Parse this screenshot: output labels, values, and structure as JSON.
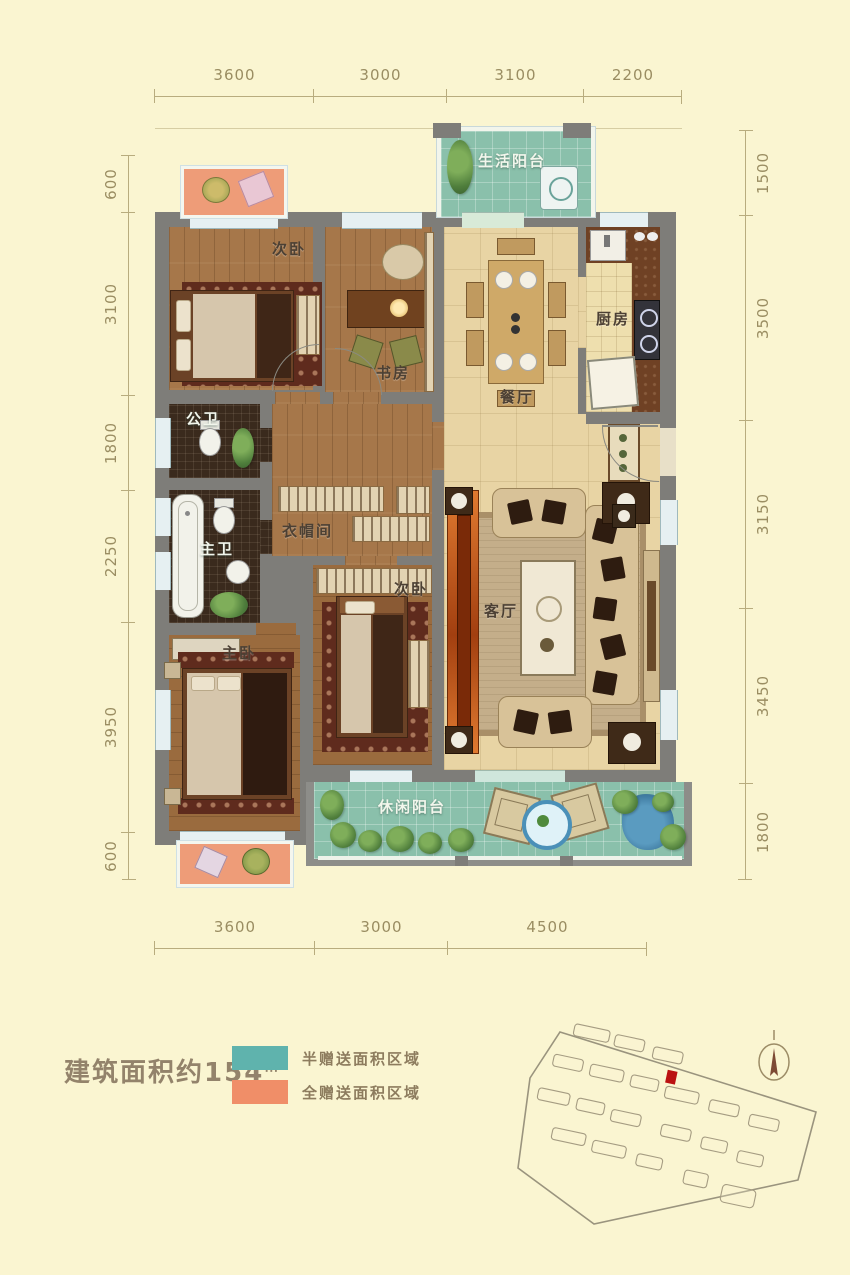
{
  "dimensions": {
    "top": [
      "3600",
      "3000",
      "3100",
      "2200"
    ],
    "bottom": [
      "3600",
      "3000",
      "4500"
    ],
    "left": [
      "600",
      "3100",
      "1800",
      "2250",
      "3950",
      "600"
    ],
    "right": [
      "1500",
      "3500",
      "3150",
      "3450",
      "1800"
    ]
  },
  "rooms": {
    "life_balcony": "生活阳台",
    "bedroom2_top": "次卧",
    "study": "书房",
    "dining": "餐厅",
    "kitchen": "厨房",
    "public_bath": "公卫",
    "master_bath": "主卫",
    "cloakroom": "衣帽间",
    "bedroom2_bottom": "次卧",
    "master_bedroom": "主卧",
    "living": "客厅",
    "leisure_balcony": "休闲阳台"
  },
  "footer": {
    "area_prefix": "建筑面积约",
    "area_value": "154",
    "area_unit": "㎡",
    "legend": [
      {
        "label": "半赠送面积区域",
        "color": "#5FB3AD"
      },
      {
        "label": "全赠送面积区域",
        "color": "#F08E68"
      }
    ]
  },
  "colors": {
    "background": "#FAF5D1",
    "wall": "#7E7D79",
    "balcony_tile": "#8AC0AB",
    "gift_full_area": "#EE9C78",
    "site_plan_unit_red": "#BB1111"
  }
}
